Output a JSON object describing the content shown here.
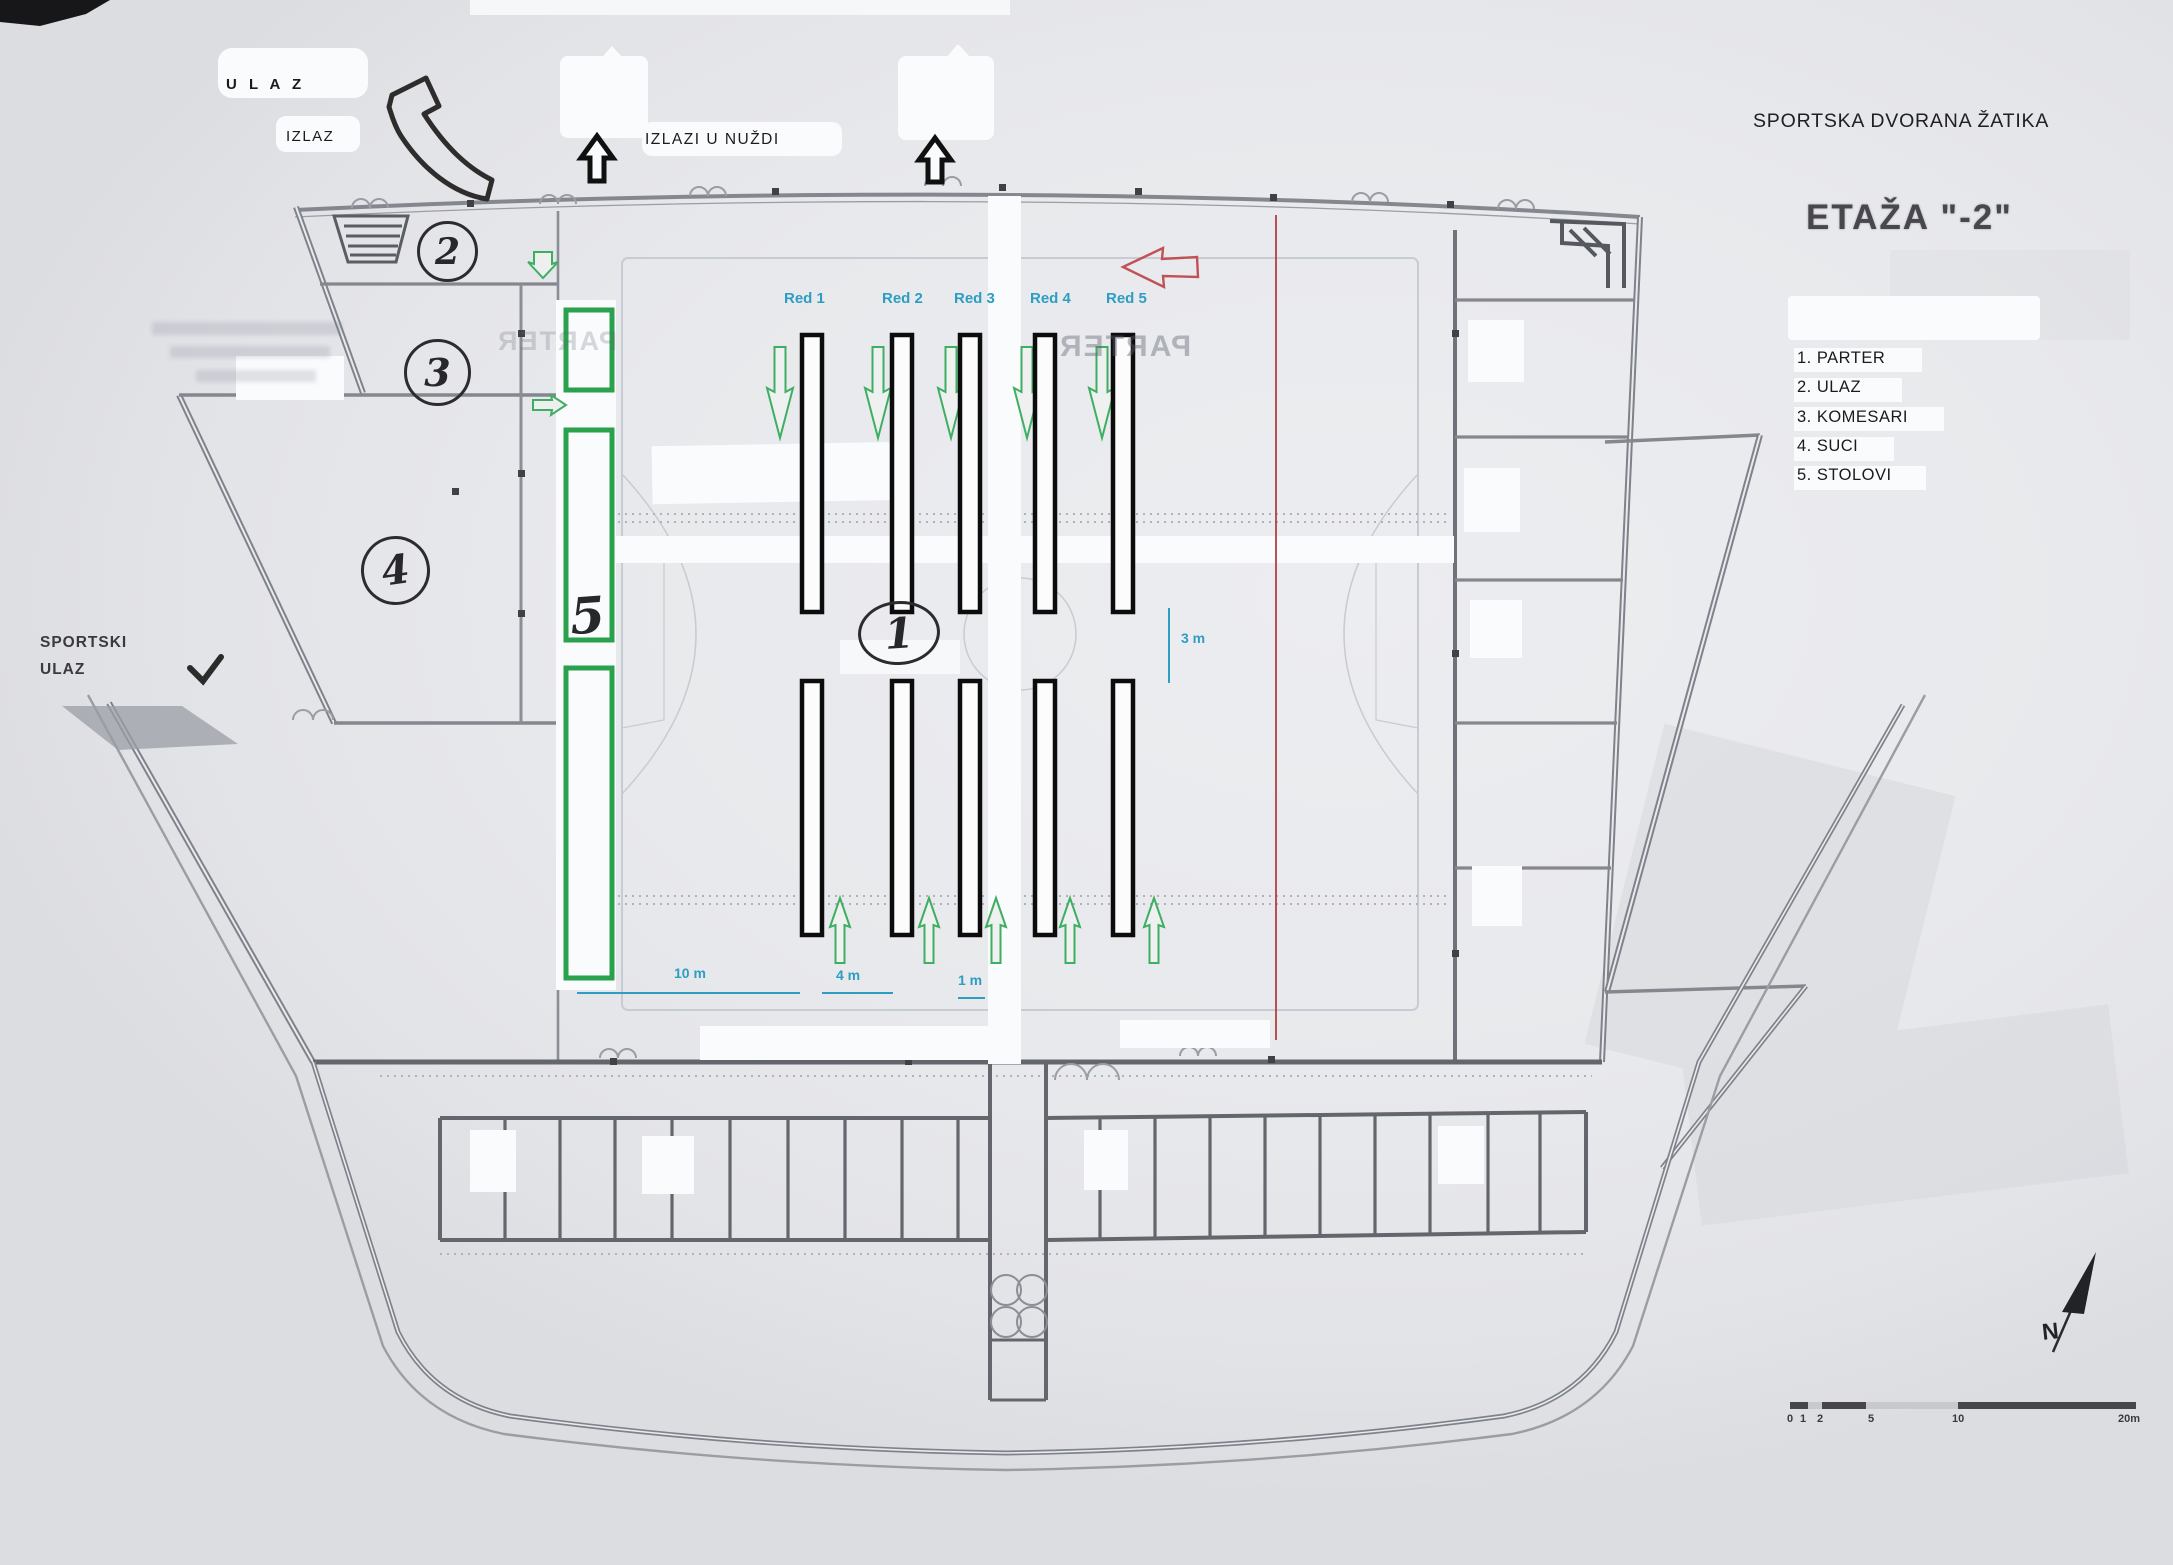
{
  "header": {
    "title": "SPORTSKA DVORANA  ŽATIKA",
    "floor": "ETAŽA \"-2\""
  },
  "legend": {
    "items": [
      "1.  PARTER",
      "2.  ULAZ",
      "3.  KOMESARI",
      "4.  SUCI",
      "5.  STOLOVI"
    ]
  },
  "labels": {
    "ulaz": "U L A Z",
    "izlaz": "IZLAZ",
    "emergency": "IZLAZI  U  NUŽDI",
    "sportski_line1": "SPORTSKI",
    "sportski_line2": "ULAZ"
  },
  "rows": {
    "labels": [
      "Red 1",
      "Red 2",
      "Red 3",
      "Red 4",
      "Red 5"
    ]
  },
  "dims": {
    "d10": "10 m",
    "d4": "4 m",
    "d1": "1 m",
    "d3": "3 m"
  },
  "markers": {
    "parter": "1",
    "ulaz": "2",
    "komesari": "3",
    "suci": "4",
    "stolovi": "5"
  },
  "compass": {
    "north": "N"
  },
  "scalebar": {
    "labels": [
      "0",
      "1",
      "2",
      "5",
      "10",
      "20m"
    ]
  },
  "ghost": {
    "parter": "PARTER"
  },
  "colors": {
    "annotation_green": "#2aa14c",
    "annotation_teal": "#2d9ec2",
    "annotation_red": "#c05156",
    "ink": "#101010",
    "plan_gray": "#84878e"
  }
}
